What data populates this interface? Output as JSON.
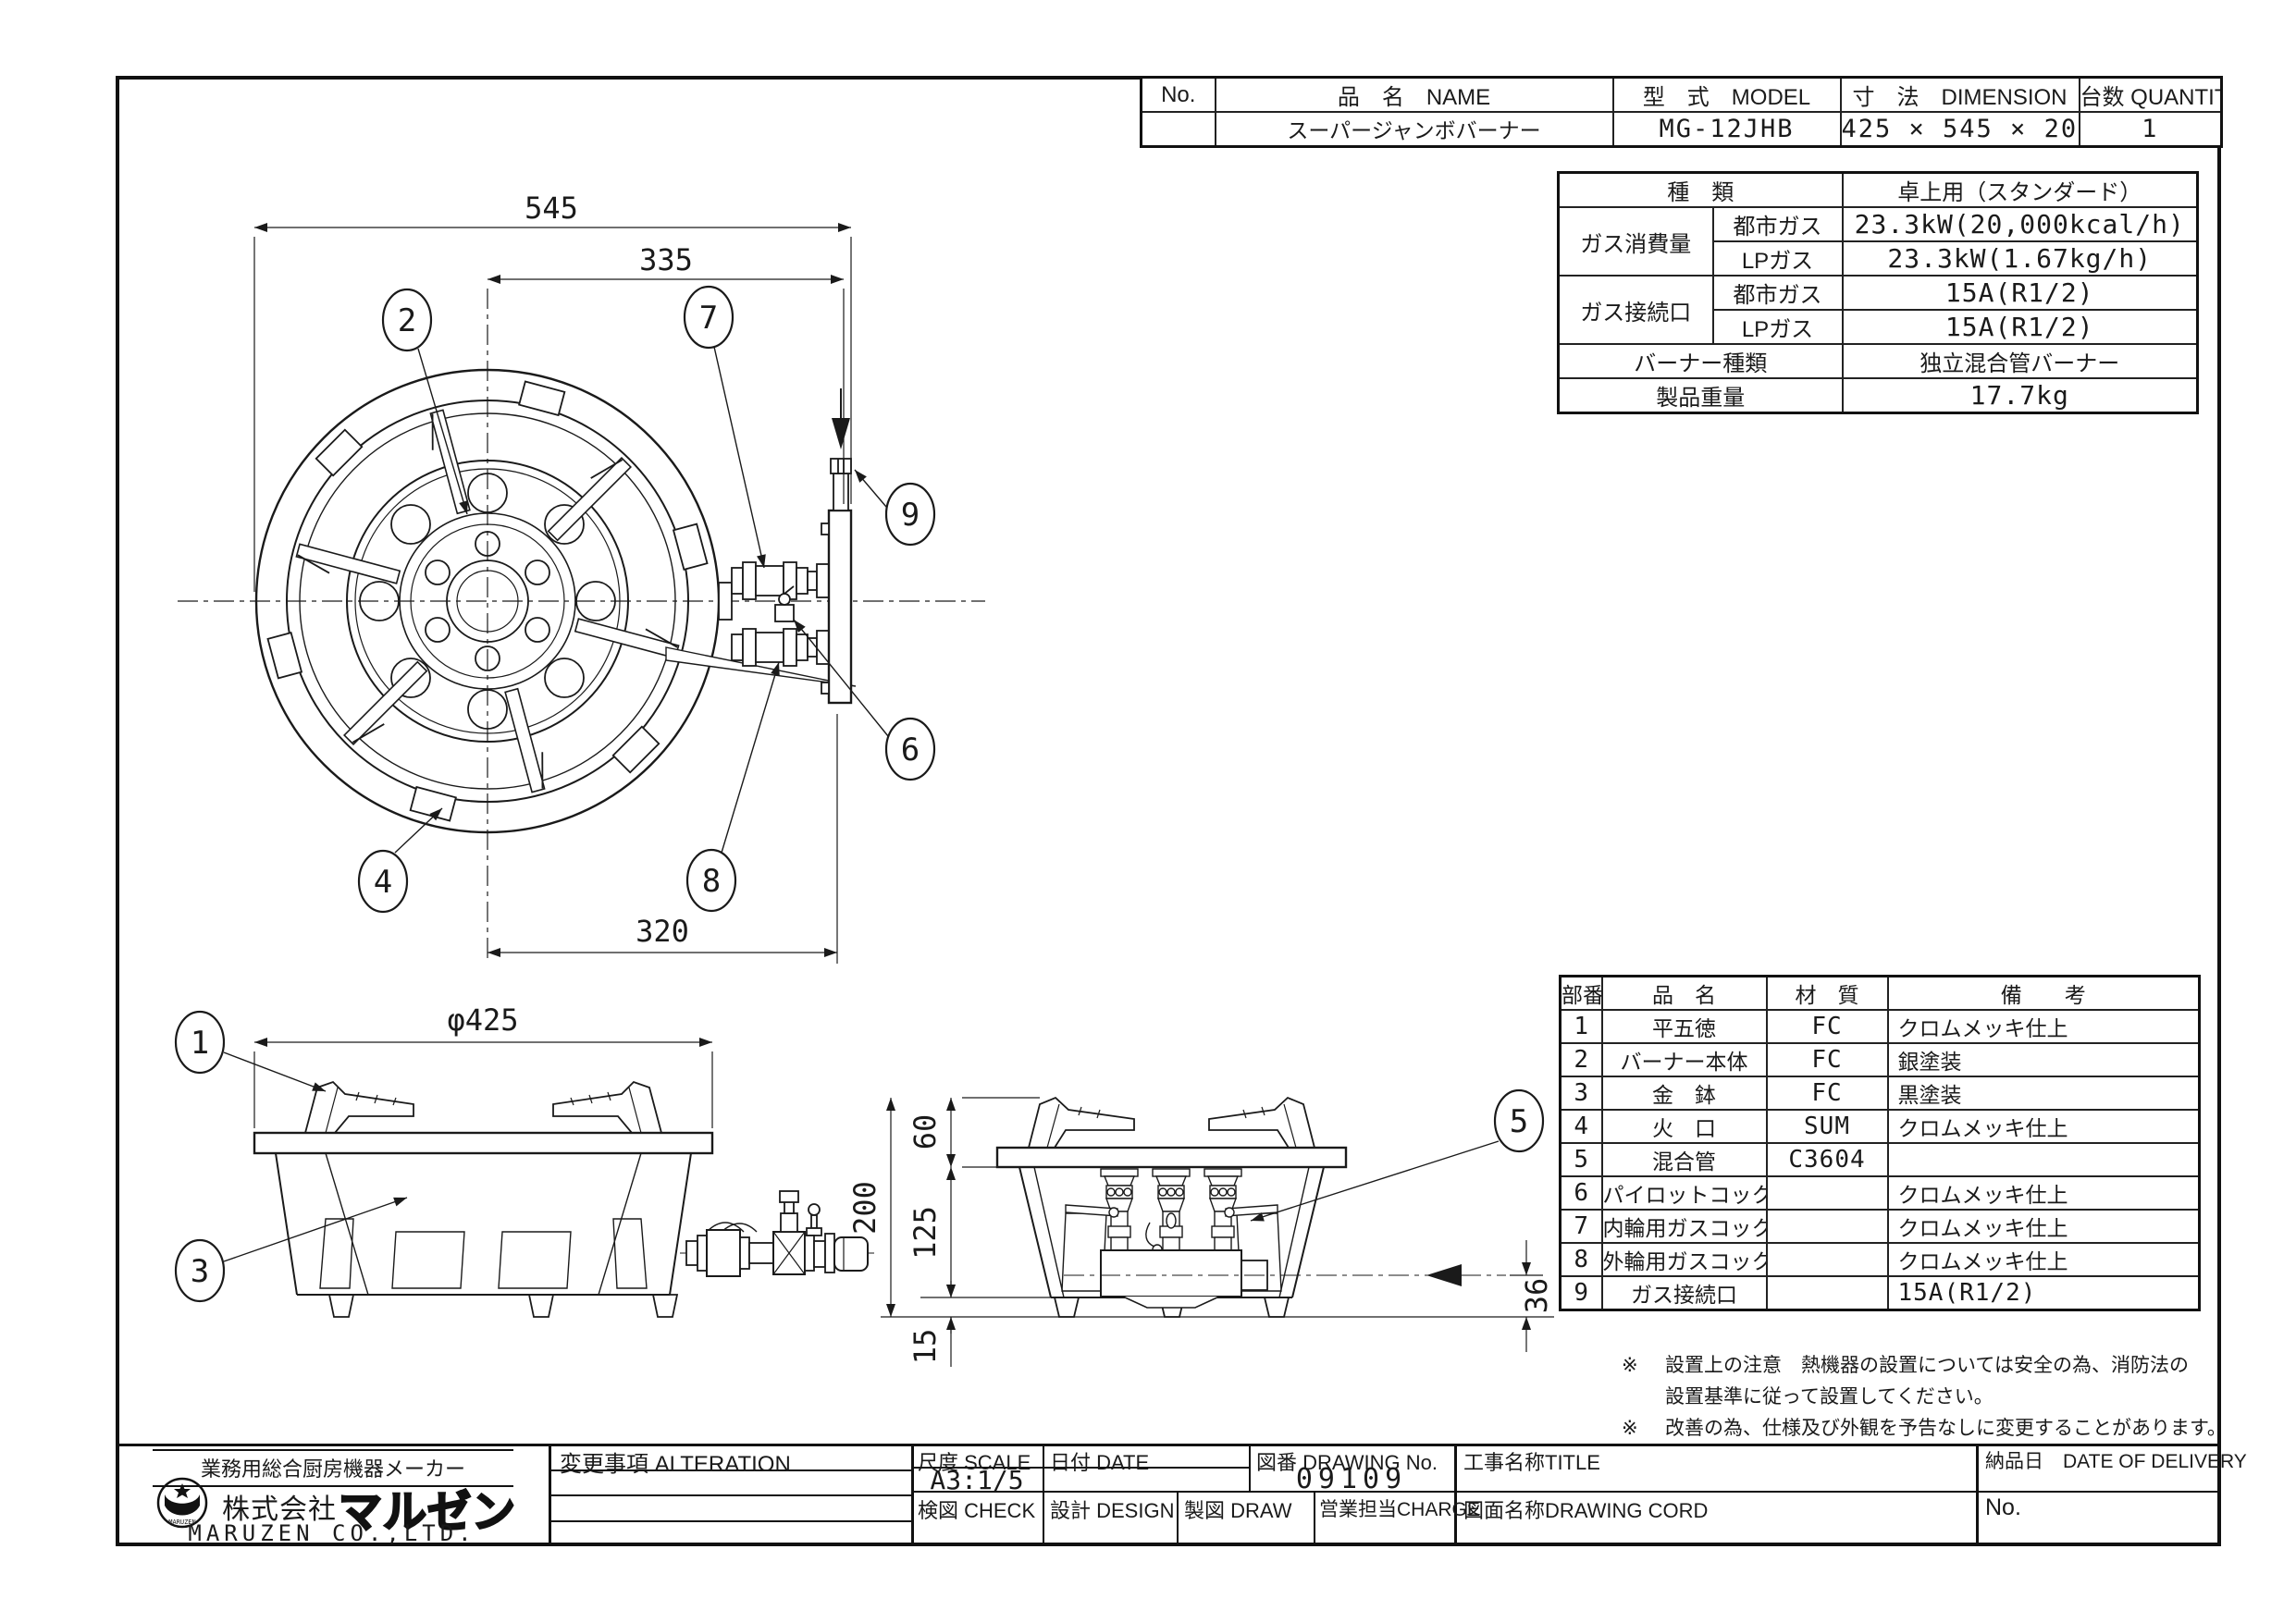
{
  "header_table": {
    "no_label": "No.",
    "name_label": "品　名　NAME",
    "model_label": "型　式　MODEL",
    "dimension_label": "寸　法　DIMENSION",
    "quantity_label": "台数 QUANTITY",
    "name": "スーパージャンボバーナー",
    "model": "MG-12JHB",
    "dimension": "425 × 545 × 200",
    "quantity": "1"
  },
  "spec_table": {
    "type_label": "種　類",
    "type_value": "卓上用（スタンダード）",
    "consumption_label": "ガス消費量",
    "consumption_city_label": "都市ガス",
    "consumption_city": "23.3kW(20,000kcal/h)",
    "consumption_lp_label": "LPガス",
    "consumption_lp": "23.3kW(1.67kg/h)",
    "connection_label": "ガス接続口",
    "connection_city_label": "都市ガス",
    "connection_city": "15A(R1/2)",
    "connection_lp_label": "LPガス",
    "connection_lp": "15A(R1/2)",
    "burner_type_label": "バーナー種類",
    "burner_type_value": "独立混合管バーナー",
    "weight_label": "製品重量",
    "weight_value": "17.7kg"
  },
  "parts_table": {
    "headers": {
      "no": "部番",
      "name": "品　名",
      "material": "材　質",
      "note": "備　　考"
    },
    "rows": [
      {
        "no": "1",
        "name": "平五徳",
        "material": "FC",
        "note": "クロムメッキ仕上"
      },
      {
        "no": "2",
        "name": "バーナー本体",
        "material": "FC",
        "note": "銀塗装"
      },
      {
        "no": "3",
        "name": "金　鉢",
        "material": "FC",
        "note": "黒塗装"
      },
      {
        "no": "4",
        "name": "火　口",
        "material": "SUM",
        "note": "クロムメッキ仕上"
      },
      {
        "no": "5",
        "name": "混合管",
        "material": "C3604",
        "note": ""
      },
      {
        "no": "6",
        "name": "パイロットコック",
        "material": "",
        "note": "クロムメッキ仕上"
      },
      {
        "no": "7",
        "name": "内輪用ガスコック",
        "material": "",
        "note": "クロムメッキ仕上"
      },
      {
        "no": "8",
        "name": "外輪用ガスコック",
        "material": "",
        "note": "クロムメッキ仕上"
      },
      {
        "no": "9",
        "name": "ガス接続口",
        "material": "",
        "note": "15A(R1/2)"
      }
    ]
  },
  "notes": {
    "mark": "※",
    "line1": "設置上の注意　熱機器の設置については安全の為、消防法の",
    "line2": "設置基準に従って設置してください。",
    "line3": "改善の為、仕様及び外観を予告なしに変更することがあります。"
  },
  "title_block": {
    "alteration_label": "変更事項  ALTERATION",
    "scale_label": "尺度 SCALE",
    "scale_value": "A3:1/5",
    "date_label": "日付 DATE",
    "drawing_no_label": "図番 DRAWING  No.",
    "drawing_no": "09109",
    "title_label": "工事名称TITLE",
    "delivery_label": "納品日　DATE  OF  DELIVERY",
    "check_label": "検図 CHECK",
    "design_label": "設計 DESIGN",
    "draw_label": "製図 DRAW",
    "charge_label": "営業担当CHARGE",
    "drawing_cord_label": "図面名称DRAWING  CORD",
    "no_label": "No.",
    "company_tagline": "業務用総合厨房機器メーカー",
    "company_prefix": "株式会社",
    "company_name": "マルゼン",
    "company_en": "MARUZEN CO.,LTD.",
    "logo_text": "MARUZEN"
  },
  "drawing": {
    "top_view": {
      "dim_width": "545",
      "dim_inner": "335",
      "dim_lower": "320"
    },
    "front_view": {
      "dim_diameter": "φ425"
    },
    "side_view": {
      "dim_height": "200",
      "dim_trivet": "60",
      "dim_body": "125",
      "dim_feet": "15",
      "dim_inlet": "36"
    },
    "balloons": [
      "1",
      "2",
      "3",
      "4",
      "5",
      "6",
      "7",
      "8",
      "9"
    ]
  }
}
